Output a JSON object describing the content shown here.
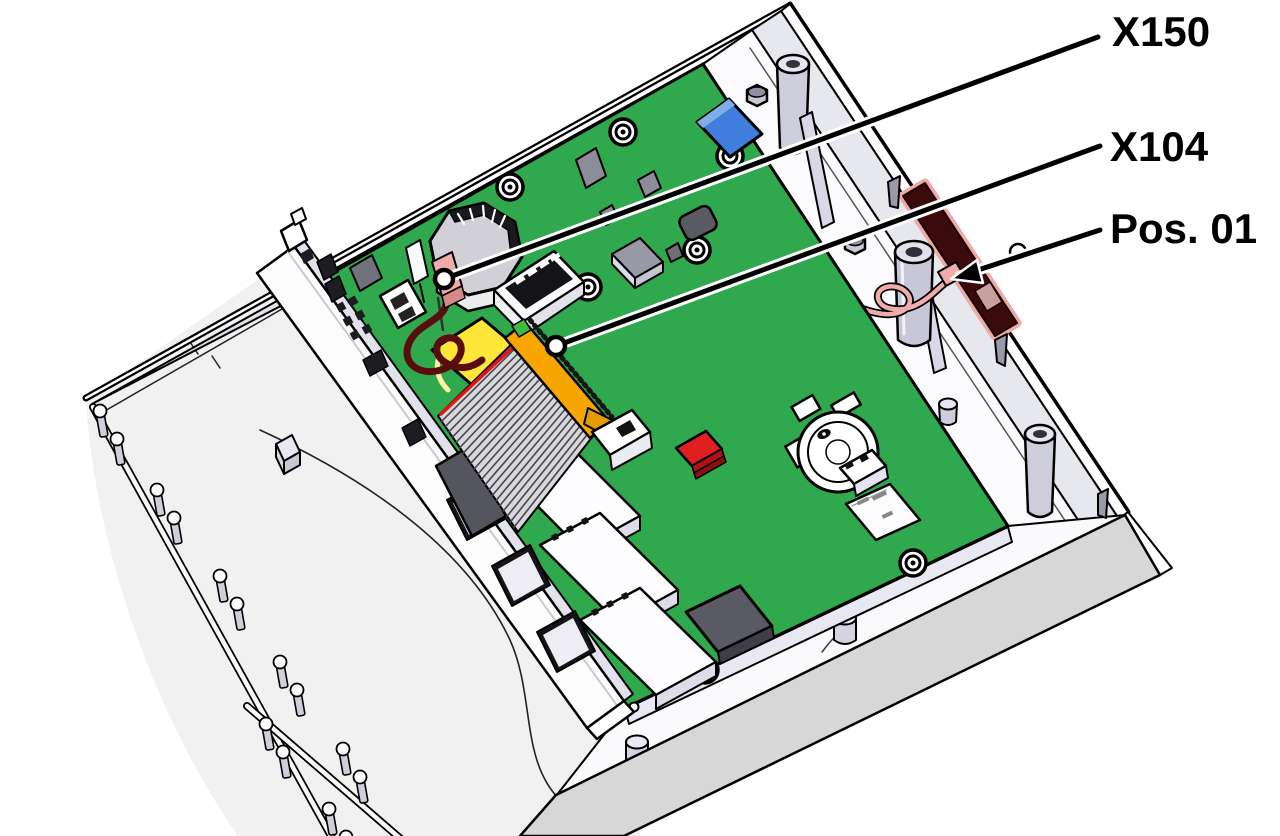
{
  "callouts": {
    "x150": {
      "label": "X150"
    },
    "x104": {
      "label": "X104"
    },
    "pos01": {
      "label": "Pos. 01"
    }
  },
  "colors": {
    "pcb_green": "#2FA84E",
    "pcb_edge": "#E8E8F2",
    "connector_orange": "#F7A600",
    "battery_yellow": "#FFE73A",
    "wire_dark_red": "#5A0D0E",
    "connector_pink": "#F2ABAB",
    "antenna_maroon": "#3A0A0C",
    "antenna_glow": "#EFA9A9",
    "component_blue": "#3F7EDD",
    "component_red": "#E02020",
    "case_band_gray": "#D7D7D7",
    "shell_gray": "#F1F1F2",
    "wall_inner": "#E7E7EE",
    "standoff_gray": "#C9C9D8",
    "chip_gray": "#8C8C9A",
    "chip_dark": "#5A5A64",
    "outline_black": "#000000"
  }
}
